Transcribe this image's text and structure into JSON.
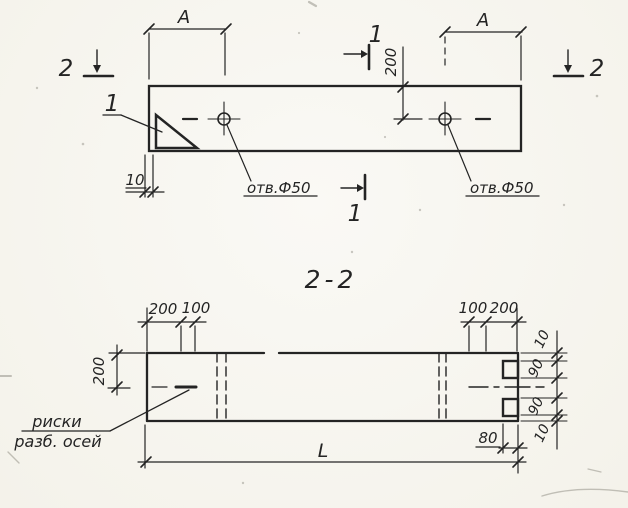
{
  "colors": {
    "paper": "#f7f5ef",
    "ink": "#242424"
  },
  "top_view": {
    "section_mark_1_top": "1",
    "section_mark_1_bottom": "1",
    "section_mark_2_left": "2",
    "section_mark_2_right": "2",
    "dim_a_left": "А",
    "dim_a_right": "А",
    "dim_200_hole_offset": "200",
    "dim_10_chamfer": "10",
    "detail_callout": "1",
    "hole_label_left": "отв.Ф50",
    "hole_label_right": "отв.Ф50"
  },
  "section_view": {
    "title": "2-2",
    "dim_200_top_left": "200",
    "dim_100_top_left": "100",
    "dim_100_top_right": "100",
    "dim_200_top_right": "200",
    "dim_200_width_half": "200",
    "dim_length": "L",
    "dim_80_notch": "80",
    "dim_10_top": "10",
    "dim_90_top": "90",
    "dim_90_bottom": "90",
    "dim_10_bottom": "10",
    "axes_note_line1": "риски",
    "axes_note_line2": "разб. осей"
  }
}
